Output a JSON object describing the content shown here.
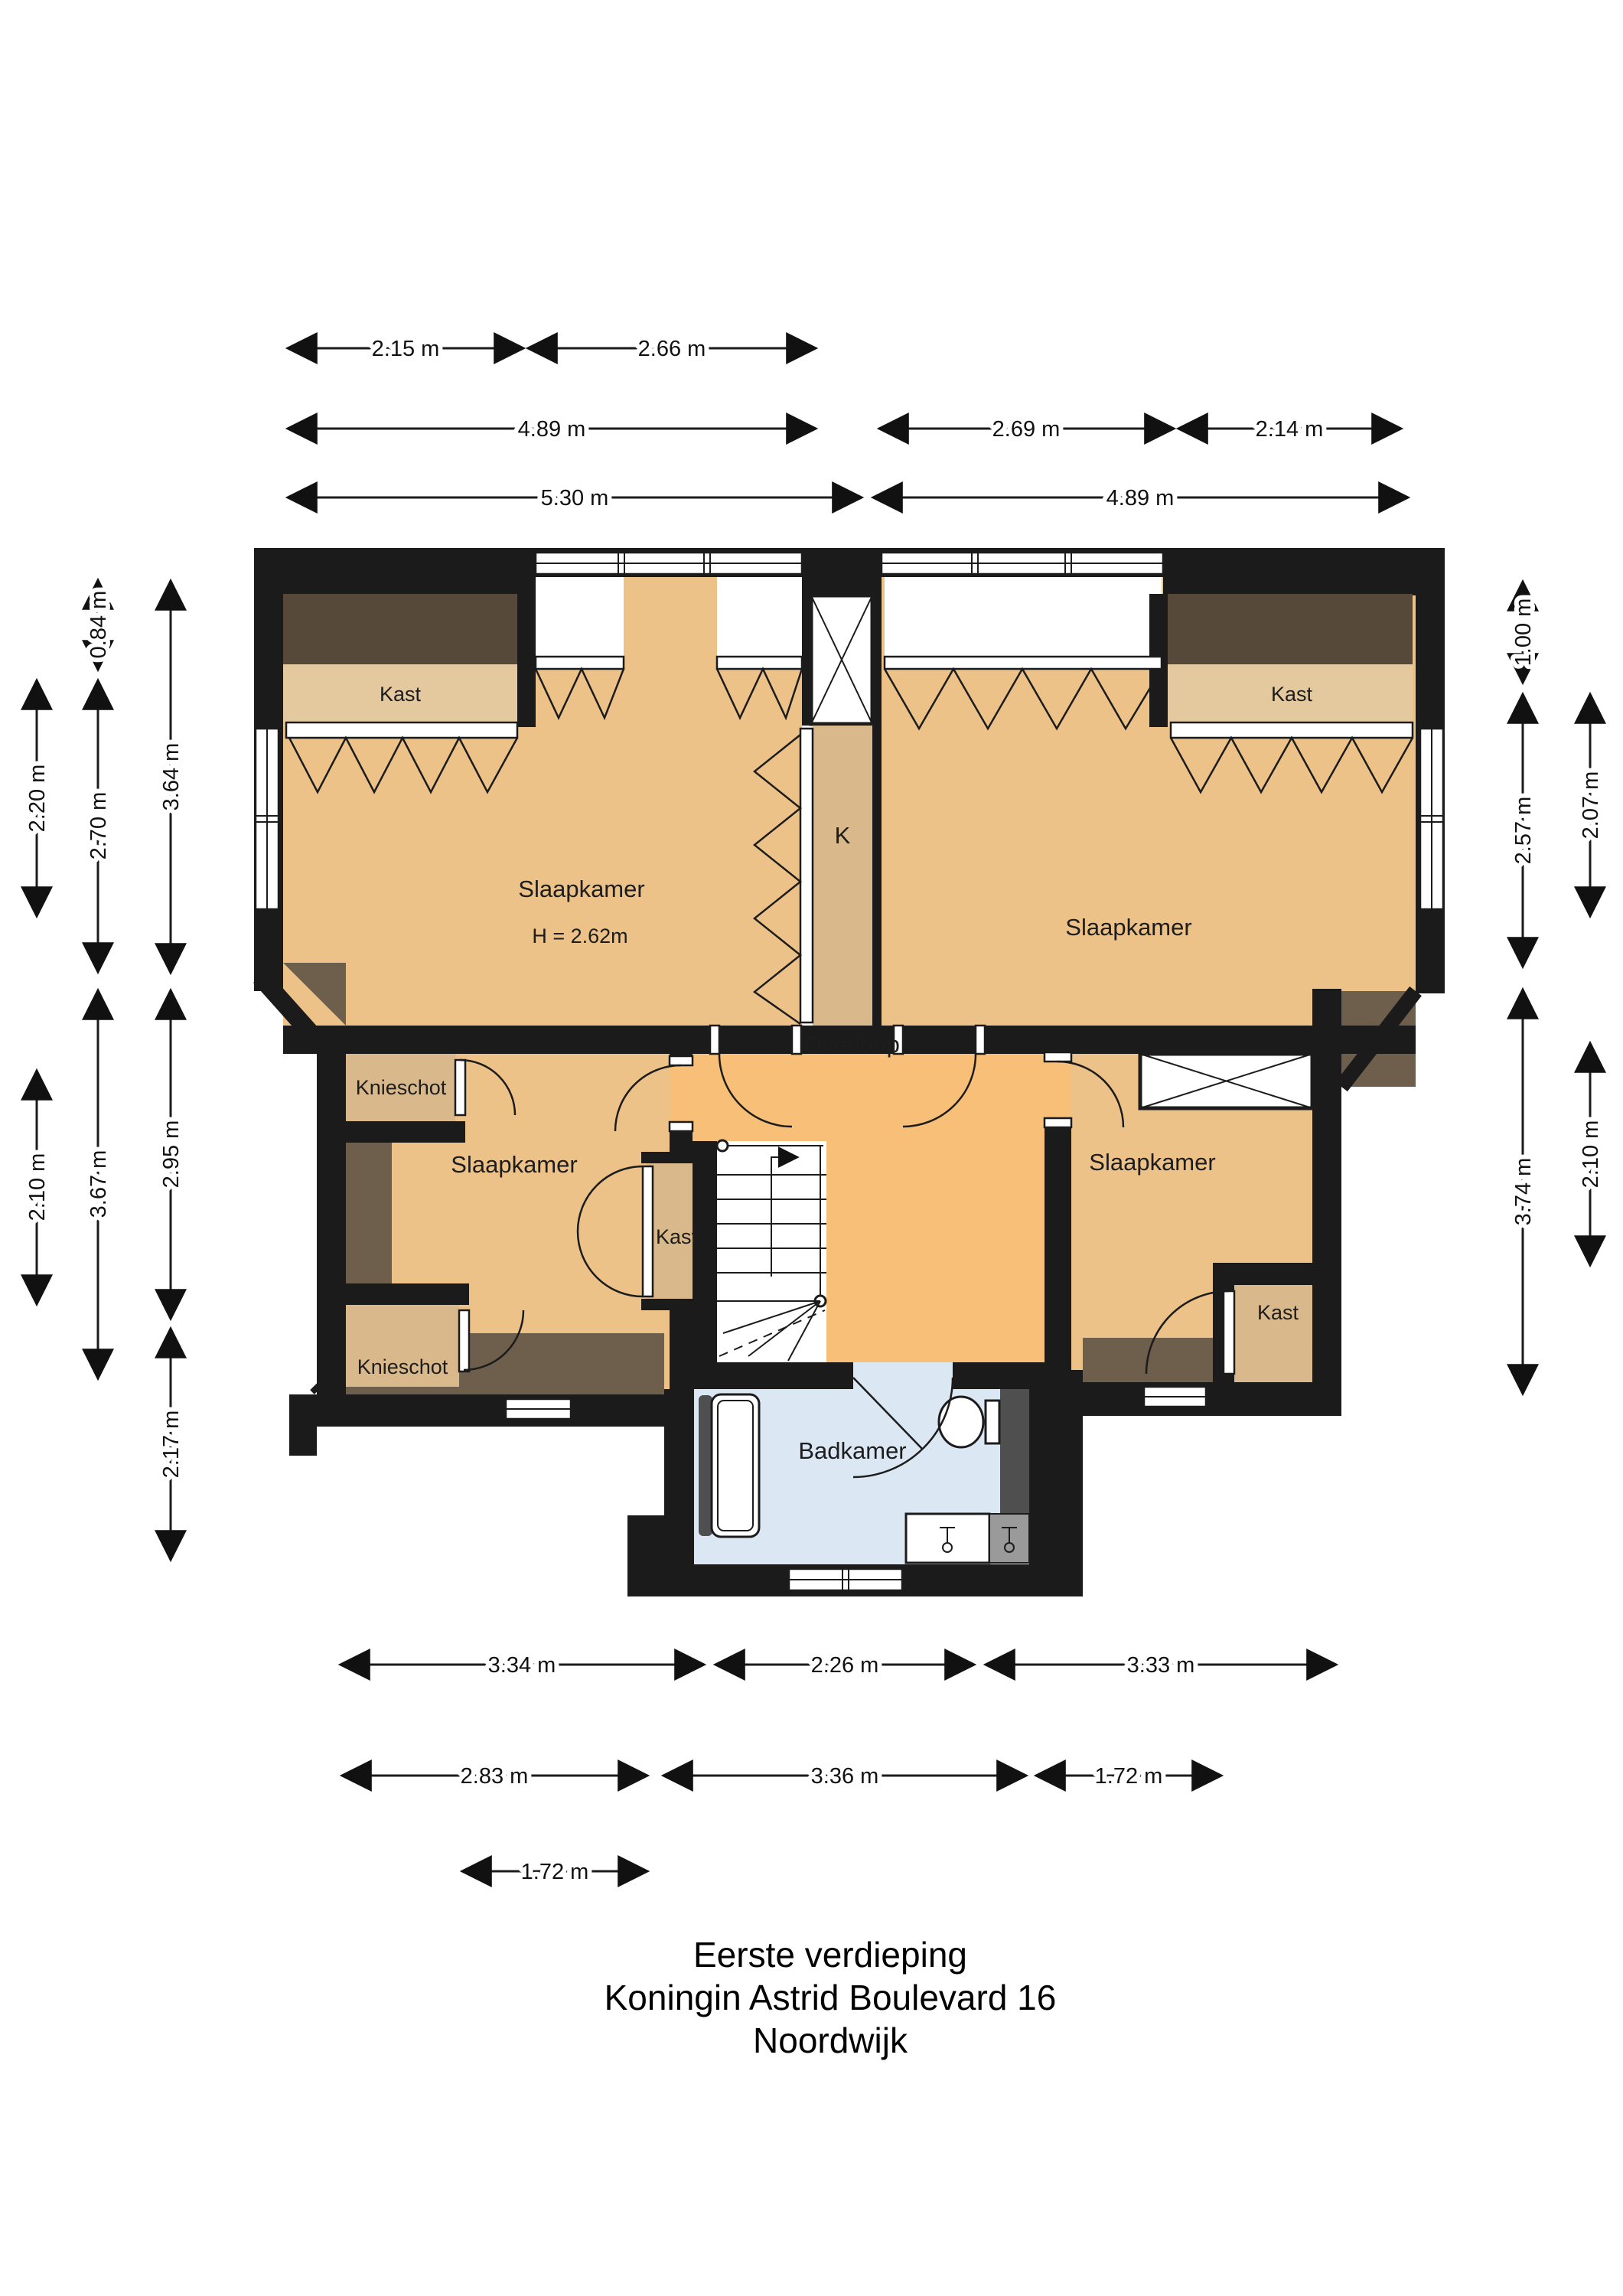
{
  "title": {
    "line1": "Eerste verdieping",
    "line2": "Koningin Astrid Boulevard 16",
    "line3": "Noordwijk"
  },
  "rooms": {
    "bedroom_tl": "Slaapkamer",
    "bedroom_tl_height": "H = 2.62m",
    "bedroom_tr": "Slaapkamer",
    "bedroom_bl": "Slaapkamer",
    "bedroom_br": "Slaapkamer",
    "landing": "Overloop",
    "bathroom": "Badkamer",
    "closet_k": "K",
    "closet_tl": "Kast",
    "closet_tr": "Kast",
    "closet_stairs": "Kast",
    "closet_br": "Kast",
    "knieschot_upper": "Knieschot",
    "knieschot_lower": "Knieschot"
  },
  "dimensions": {
    "top_row1": [
      "2.15 m",
      "2.66 m"
    ],
    "top_row2": [
      "4.89 m",
      "2.69 m",
      "2.14 m"
    ],
    "top_row3": [
      "5.30 m",
      "4.89 m"
    ],
    "left_outer": [
      "2.20 m",
      "2.10 m"
    ],
    "left_middle": [
      "0.84 m",
      "2.70 m",
      "3.67 m"
    ],
    "left_inner": [
      "3.64 m",
      "2.95 m",
      "2.17 m"
    ],
    "right_inner": [
      "1.00 m",
      "2.57 m",
      "3.74 m"
    ],
    "right_outer": [
      "2.07 m",
      "2.10 m"
    ],
    "bottom_row1": [
      "3.34 m",
      "2.26 m",
      "3.33 m"
    ],
    "bottom_row2": [
      "2.83 m",
      "3.36 m",
      "1.72 m"
    ],
    "bottom_row3": [
      "1.72 m"
    ]
  },
  "colors": {
    "wall": "#1b1b1b",
    "line": "#1c1c1c",
    "room": "#ecc289",
    "landing": "#f7bf77",
    "closet": "#d9b98b",
    "closet_light": "#e4c99e",
    "slope_dark": "#564939",
    "slope_mid": "#6e5f4c",
    "bathroom": "#dbe7f3",
    "fixture_gray": "#4f4f4f",
    "fixture_light": "#9a9a9a"
  }
}
